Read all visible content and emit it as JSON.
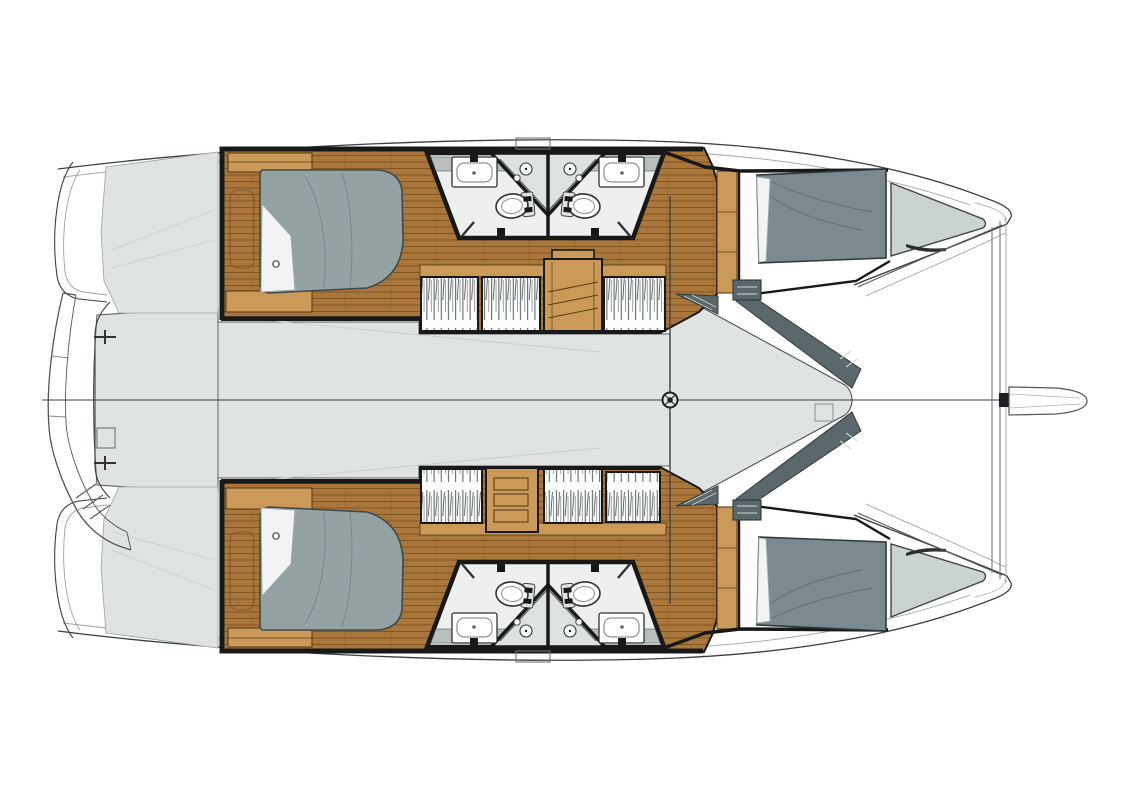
{
  "meta": {
    "type": "floor-plan",
    "subject": "sailing-catamaran",
    "view": "overhead-layout",
    "hull_count": 2,
    "cabin_count": 4,
    "head_count": 4
  },
  "palette": {
    "bg": "#ffffff",
    "ink": "#3a4043",
    "soft": "#9aa3a2",
    "wall": "#181818",
    "deck": "#dfe4e2",
    "deckline": "#c9d0ce",
    "wood": "#a9773c",
    "woodline": "#82561f",
    "furniture": "#cb9a58",
    "furnline": "#5a3c17",
    "bed": "#95a2a3",
    "beddark": "#7b8a8e",
    "bedline": "#3f4a4d",
    "linen": "#f2f4f3",
    "shelf": "#cad3d1",
    "coaming": "#5a686b",
    "coamline": "#2e3638",
    "bath": "#edf0ef",
    "counter": "#b8c0bf",
    "fixture": "#ffffff",
    "fixline": "#2f3335"
  },
  "parts": {
    "hulls": [
      {
        "side": "port",
        "features": [
          "transom-platform",
          "aft-cabin-double-berth",
          "en-suite-head-aft",
          "en-suite-head-forward",
          "twin-sinks",
          "twin-toilets",
          "hanging-lockers",
          "companionway-steps",
          "forward-cabin-double-berth",
          "bow-shelf"
        ]
      },
      {
        "side": "starboard",
        "features": [
          "transom-platform",
          "aft-cabin-double-berth",
          "en-suite-head-aft",
          "en-suite-head-forward",
          "twin-sinks",
          "twin-toilets",
          "hanging-lockers",
          "companionway-steps",
          "forward-cabin-double-berth",
          "bow-shelf"
        ]
      }
    ],
    "shared": [
      "bridgedeck-saloon",
      "forward-cockpit",
      "mast-step",
      "mast-beam",
      "centerline",
      "forward-crossbeam",
      "bowsprit",
      "dinghy-on-davits",
      "stern-recess"
    ]
  }
}
